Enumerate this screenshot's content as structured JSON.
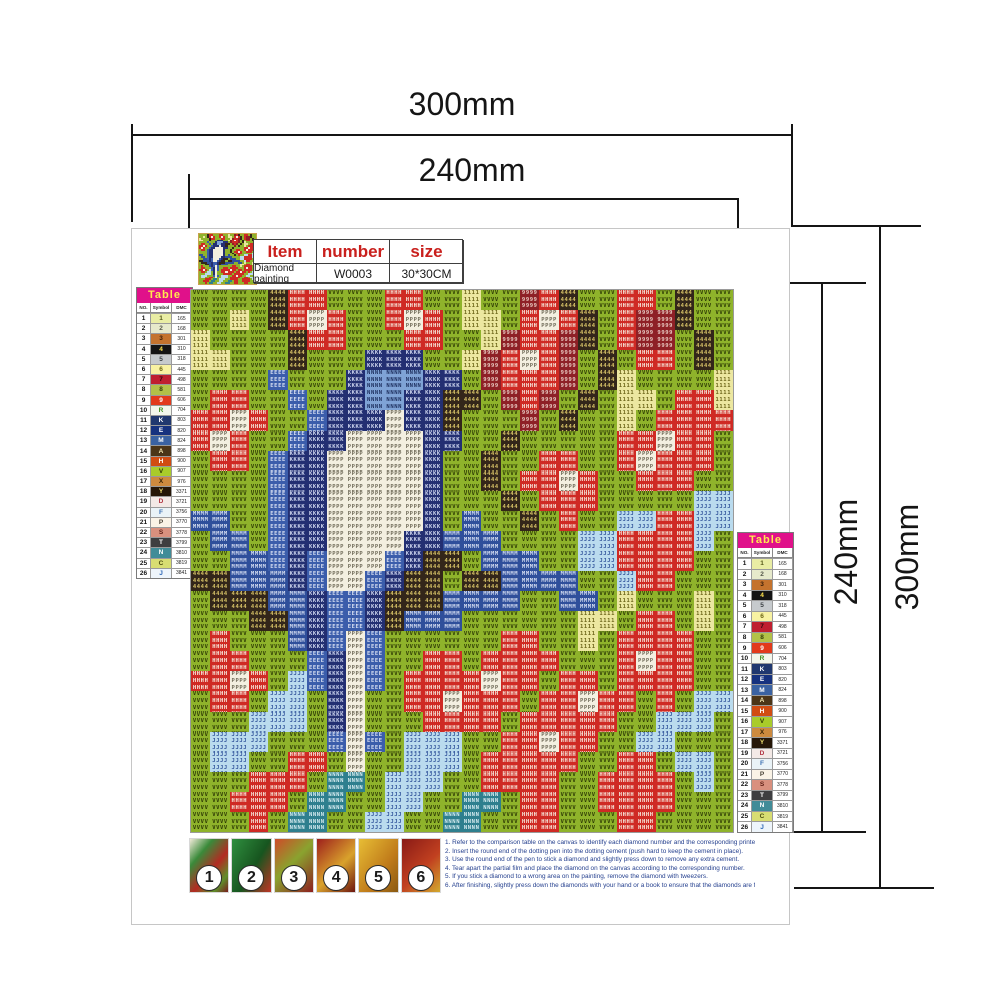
{
  "dimensions": {
    "outer_width": "300mm",
    "inner_width": "240mm",
    "inner_height": "240mm",
    "outer_height": "300mm"
  },
  "item_table": {
    "headers": {
      "item": "Item",
      "number": "number",
      "size": "size"
    },
    "values": {
      "item": "Diamond painting",
      "number": "W0003",
      "size": "30*30CM"
    }
  },
  "color_table": {
    "title": "Table",
    "columns": [
      "NO.",
      "Symbol",
      "DMC"
    ],
    "rows": [
      {
        "no": "1",
        "symbol": "1",
        "dmc": "165",
        "bg": "#e9eda4",
        "fg": "#55581a"
      },
      {
        "no": "2",
        "symbol": "2",
        "dmc": "168",
        "bg": "#e6e9cb",
        "fg": "#55584a"
      },
      {
        "no": "3",
        "symbol": "3",
        "dmc": "301",
        "bg": "#c4732e",
        "fg": "#3a1d08"
      },
      {
        "no": "4",
        "symbol": "4",
        "dmc": "310",
        "bg": "#141414",
        "fg": "#ffe34d"
      },
      {
        "no": "5",
        "symbol": "5",
        "dmc": "318",
        "bg": "#c6cacd",
        "fg": "#3c4044"
      },
      {
        "no": "6",
        "symbol": "6",
        "dmc": "445",
        "bg": "#f8f2a2",
        "fg": "#6b6414"
      },
      {
        "no": "7",
        "symbol": "7",
        "dmc": "498",
        "bg": "#bf1f30",
        "fg": "#2e060c"
      },
      {
        "no": "8",
        "symbol": "8",
        "dmc": "581",
        "bg": "#b2c148",
        "fg": "#333f07"
      },
      {
        "no": "9",
        "symbol": "9",
        "dmc": "606",
        "bg": "#e23a1c",
        "fg": "#ffffff"
      },
      {
        "no": "10",
        "symbol": "R",
        "dmc": "704",
        "bg": "#f3f7ec",
        "fg": "#3f8f1f"
      },
      {
        "no": "11",
        "symbol": "K",
        "dmc": "803",
        "bg": "#20386f",
        "fg": "#ffffff"
      },
      {
        "no": "12",
        "symbol": "E",
        "dmc": "820",
        "bg": "#16327f",
        "fg": "#ffffff"
      },
      {
        "no": "13",
        "symbol": "M",
        "dmc": "824",
        "bg": "#3a62a2",
        "fg": "#ffffff"
      },
      {
        "no": "14",
        "symbol": "A",
        "dmc": "898",
        "bg": "#4c3517",
        "fg": "#f3e6b0"
      },
      {
        "no": "15",
        "symbol": "H",
        "dmc": "900",
        "bg": "#d14c12",
        "fg": "#ffffff"
      },
      {
        "no": "16",
        "symbol": "V",
        "dmc": "907",
        "bg": "#a9cc2a",
        "fg": "#2f3a05"
      },
      {
        "no": "17",
        "symbol": "X",
        "dmc": "976",
        "bg": "#cd8a3e",
        "fg": "#3a2506"
      },
      {
        "no": "18",
        "symbol": "Y",
        "dmc": "3371",
        "bg": "#251607",
        "fg": "#f0e071"
      },
      {
        "no": "19",
        "symbol": "D",
        "dmc": "3721",
        "bg": "#f3e9e6",
        "fg": "#b03240"
      },
      {
        "no": "20",
        "symbol": "F",
        "dmc": "3756",
        "bg": "#eaf3f7",
        "fg": "#3a6fb0"
      },
      {
        "no": "21",
        "symbol": "P",
        "dmc": "3770",
        "bg": "#faf3e6",
        "fg": "#4a4438"
      },
      {
        "no": "22",
        "symbol": "S",
        "dmc": "3778",
        "bg": "#d9907e",
        "fg": "#5c1d14"
      },
      {
        "no": "23",
        "symbol": "T",
        "dmc": "3799",
        "bg": "#3e3e40",
        "fg": "#ffffff"
      },
      {
        "no": "24",
        "symbol": "N",
        "dmc": "3810",
        "bg": "#418c98",
        "fg": "#ffffff"
      },
      {
        "no": "25",
        "symbol": "C",
        "dmc": "3819",
        "bg": "#d8dd72",
        "fg": "#4c4e10"
      },
      {
        "no": "26",
        "symbol": "J",
        "dmc": "3841",
        "bg": "#eef5fb",
        "fg": "#2a65b5"
      }
    ]
  },
  "artwork": {
    "cols": 28,
    "palette": {
      "g": {
        "bg": "#8fb32b",
        "fg": "#2f3c05",
        "symbol": "V"
      },
      "y": {
        "bg": "#ece7a0",
        "fg": "#6b6418",
        "symbol": "1"
      },
      "r": {
        "bg": "#cf2a24",
        "fg": "#f7ece0",
        "symbol": "H"
      },
      "R": {
        "bg": "#8e2026",
        "fg": "#e8c8c0",
        "symbol": "9"
      },
      "w": {
        "bg": "#f3efe0",
        "fg": "#6f6a58",
        "symbol": "P"
      },
      "b": {
        "bg": "#3b5dab",
        "fg": "#d8e0f2",
        "symbol": "E"
      },
      "B": {
        "bg": "#232f72",
        "fg": "#cdd5ee",
        "symbol": "K"
      },
      "L": {
        "bg": "#7fa3d6",
        "fg": "#1d2f5e",
        "symbol": "N"
      },
      "s": {
        "bg": "#badbee",
        "fg": "#33569c",
        "symbol": "J"
      },
      "k": {
        "bg": "#33261a",
        "fg": "#d9c468",
        "symbol": "4"
      },
      "n": {
        "bg": "#2f4f9b",
        "fg": "#d3dcf0",
        "symbol": "M"
      },
      "t": {
        "bg": "#2e7f8e",
        "fg": "#d7ecf0",
        "symbol": "N"
      }
    },
    "rows": [
      "ggggkrrgggrrggyggRrkggrrgkgg",
      "ggygkrwrggrwrgyygrwrkgrRRkgg",
      "yggggkrrgggrrggyRrrRkgrRRgkg",
      "yygggkgggBBBggyRrwrRgkgrrgkg",
      "ggggbgggBLLLBBgRrrrRgkyggggy",
      "grrggbgBBLLBBkkgRrRgkgyygrry",
      "rrwrggbBBBwBBkgggRgkggygrrrr",
      "rwrggbBBwwwwBBggkgggggrrwrrg",
      "grrgbBBwwwwwBggkggrrggrwrrrg",
      "ggggbBBwwwwwBggkgrrwrggrrrgg",
      "ggggbBBwwwwwBgggkgrrrgggggss",
      "nnggbBBwwwwwBgnggkgrggssrrss",
      "gnngbBBwwwwBBnnnggggssrrrrsg",
      "ggnnbBbwwwbBkkgnnnggssrrrrgg",
      "kknnnBbwwbBkkgkknnnnggsrrggg",
      "gkkknnBbbBkkknnnnggnngygggyg",
      "gggkknBbbBknnnggggggyygrrgyg",
      "grgggnBbwbggggggrrggygrrrrgg",
      "grrgggbBwbggrrgrrrrgggrwrrgg",
      "rrwrgsbBwbgrrrrwrrgrrgrrrrgg",
      "grrgssgBwggrrwrrrgrrwrrgrgss",
      "gggsssgBwgggrrrrgrrrrrggsssg",
      "gsssgggbwbgsssggrrwrrggssggg",
      "gssggrrgwggsssgrrrrrggrrgssg",
      "gggrrrgttgsssggrrrrggrrrrgsg",
      "ggrrrgttggssggttgrrggrrrrggg",
      "gggrgttggssggttggrrgggrrgggg"
    ]
  },
  "steps": {
    "numbers": [
      "1",
      "2",
      "3",
      "4",
      "5",
      "6"
    ]
  },
  "instructions": {
    "lines": [
      "1. Refer to the comparison table on the canvas to identify each diamond number and the corresponding printed number on the canvas.",
      "2. Insert the round end of the dotting pen into the dotting cement (push hard to keep the cement in place).",
      "3. Use the round end of the pen to stick a diamond and slightly press down to remove any extra cement.",
      "4. Tear apart the partial film and place the diamond on the canvas according to the corresponding number.",
      "5. If you stick a diamond to a wrong area on the painting, remove the diamond with tweezers.",
      "6. After finishing, slightly press down the diamonds with your hand or a book to ensure that the diamonds are firmly attached."
    ]
  }
}
